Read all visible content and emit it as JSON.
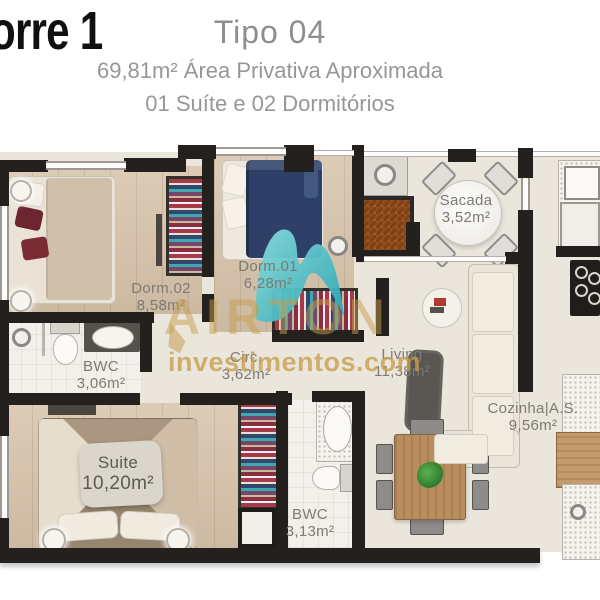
{
  "header": {
    "tower_label": "orre 1",
    "plan_type": "Tipo 04",
    "area_line": "69,81m² Área Privativa Aproximada",
    "config_line": "01 Suíte e 02 Dormitórios"
  },
  "watermark": {
    "brand": "AIRTON",
    "domain": "investimentos.com"
  },
  "rooms": {
    "dorm02": {
      "name": "Dorm.02",
      "area": "8,58m²"
    },
    "dorm01": {
      "name": "Dorm.01",
      "area": "6,28m²"
    },
    "sacada": {
      "name": "Sacada",
      "area": "3,52m²"
    },
    "bwc_social": {
      "name": "BWC",
      "area": "3,06m²"
    },
    "circ": {
      "name": "Circ.",
      "area": "3,62m²"
    },
    "living": {
      "name": "Living",
      "area": "11,38m²"
    },
    "cozinha": {
      "name": "Cozinha|A.S.",
      "area": "9,56m²"
    },
    "suite": {
      "name": "Suite",
      "area": "10,20m²"
    },
    "bwc_suite": {
      "name": "BWC",
      "area": "3,13m²"
    }
  },
  "colors": {
    "wall": "#23201d",
    "floor_cream": "#ebe6dc",
    "floor_wood": "#d7c3aa",
    "accent_teal": "#3fb9c2",
    "watermark_gold": "#c69d4e",
    "bed_navy": "#2e4068",
    "label_gray": "#7d7a74"
  }
}
